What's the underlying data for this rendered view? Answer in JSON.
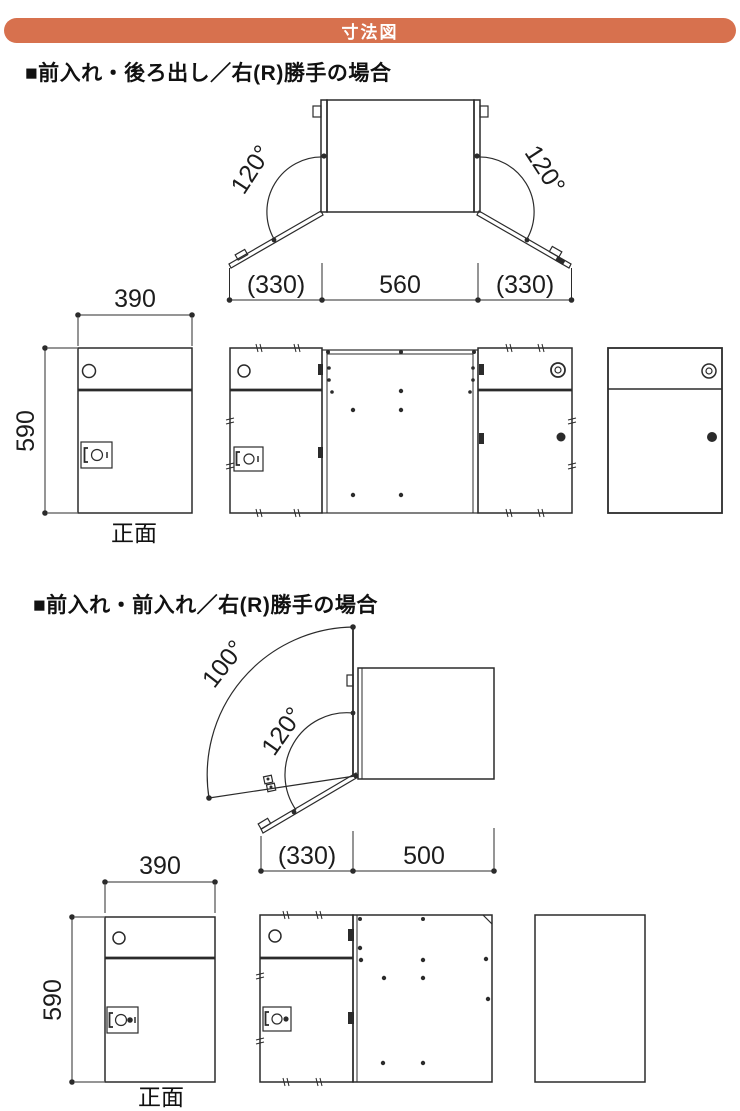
{
  "header": {
    "title": "寸法図"
  },
  "colors": {
    "accent": "#d7714e",
    "line": "#2b2b2b"
  },
  "sections": [
    {
      "title": "■前入れ・後ろ出し／右(R)勝手の場合",
      "top_view": {
        "angle_left": "120°",
        "angle_right": "120°",
        "dims": {
          "left": "(330)",
          "center": "560",
          "right": "(330)"
        }
      },
      "front_row": {
        "width_dim": "390",
        "height_dim": "590",
        "caption": "正面"
      }
    },
    {
      "title": "■前入れ・前入れ／右(R)勝手の場合",
      "top_view": {
        "angle_upper": "100°",
        "angle_lower": "120°",
        "dims": {
          "left": "(330)",
          "right": "500"
        }
      },
      "front_row": {
        "width_dim": "390",
        "height_dim": "590",
        "caption": "正面"
      }
    }
  ]
}
